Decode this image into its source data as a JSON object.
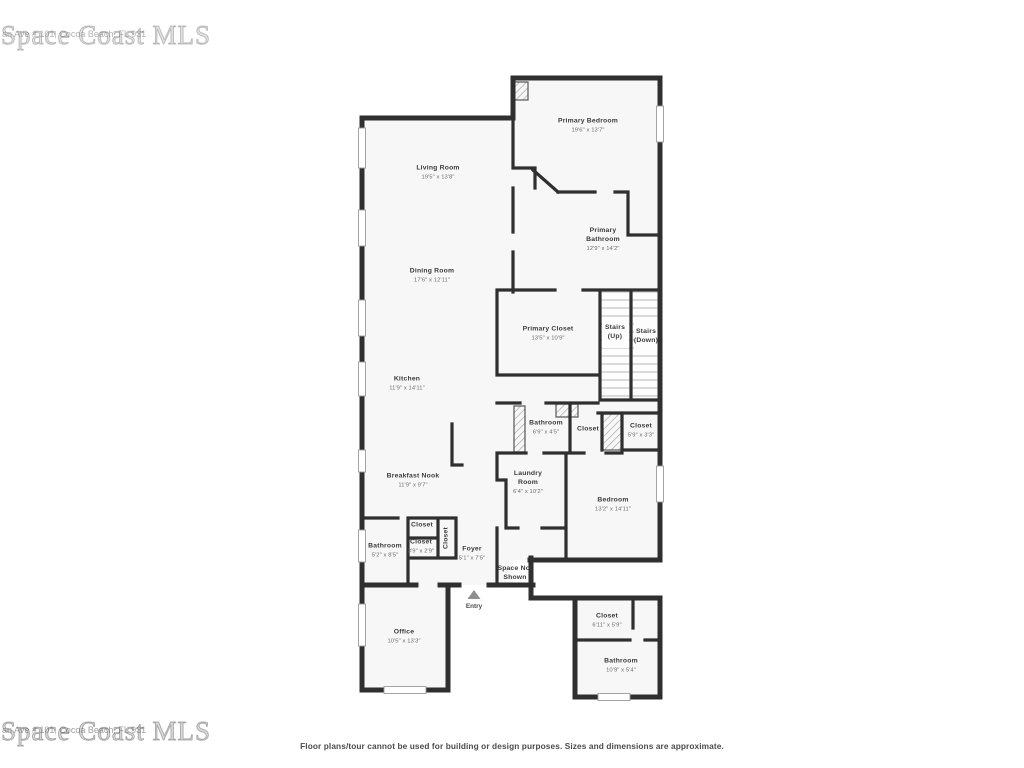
{
  "watermark": {
    "brand": "Space Coast MLS",
    "address_fragment": "an Ave # 101, Cocoa Beach, FL 931"
  },
  "disclaimer": "Floor plans/tour cannot be used for building or design purposes. Sizes and dimensions are approximate.",
  "entry_label": "Entry",
  "rooms": [
    {
      "name": "Primary Bedroom",
      "dims": "19'6\" x 13'7\""
    },
    {
      "name": "Living Room",
      "dims": "19'5\" x 13'8\""
    },
    {
      "name": "Dining Room",
      "dims": "17'6\" x 12'11\""
    },
    {
      "name": "Primary Bathroom",
      "dims": "12'9\" x 14'2\""
    },
    {
      "name": "Primary Closet",
      "dims": "13'5\" x 10'9\""
    },
    {
      "name": "Stairs (Up)",
      "dims": ""
    },
    {
      "name": "Stairs (Down)",
      "dims": ""
    },
    {
      "name": "Kitchen",
      "dims": "11'9\" x 14'11\""
    },
    {
      "name": "Bathroom",
      "dims": "6'9\" x 4'5\""
    },
    {
      "name": "Closet",
      "dims": ""
    },
    {
      "name": "Closet",
      "dims": "5'9\" x 3'3\""
    },
    {
      "name": "Breakfast Nook",
      "dims": "11'9\" x 9'7\""
    },
    {
      "name": "Laundry Room",
      "dims": "6'4\" x 10'2\""
    },
    {
      "name": "Bedroom",
      "dims": "13'2\" x 14'11\""
    },
    {
      "name": "Closet",
      "dims": ""
    },
    {
      "name": "Closet",
      "dims": "3'9\" x 2'9\""
    },
    {
      "name": "Closet",
      "dims": ""
    },
    {
      "name": "Bathroom",
      "dims": "5'2\" x 8'5\""
    },
    {
      "name": "Foyer",
      "dims": "5'1\" x 7'5\""
    },
    {
      "name": "Space Not Shown",
      "dims": ""
    },
    {
      "name": "Office",
      "dims": "10'5\" x 13'3\""
    },
    {
      "name": "Closet",
      "dims": "6'11\" x 5'9\""
    },
    {
      "name": "Bathroom",
      "dims": "10'9\" x 5'4\""
    }
  ]
}
